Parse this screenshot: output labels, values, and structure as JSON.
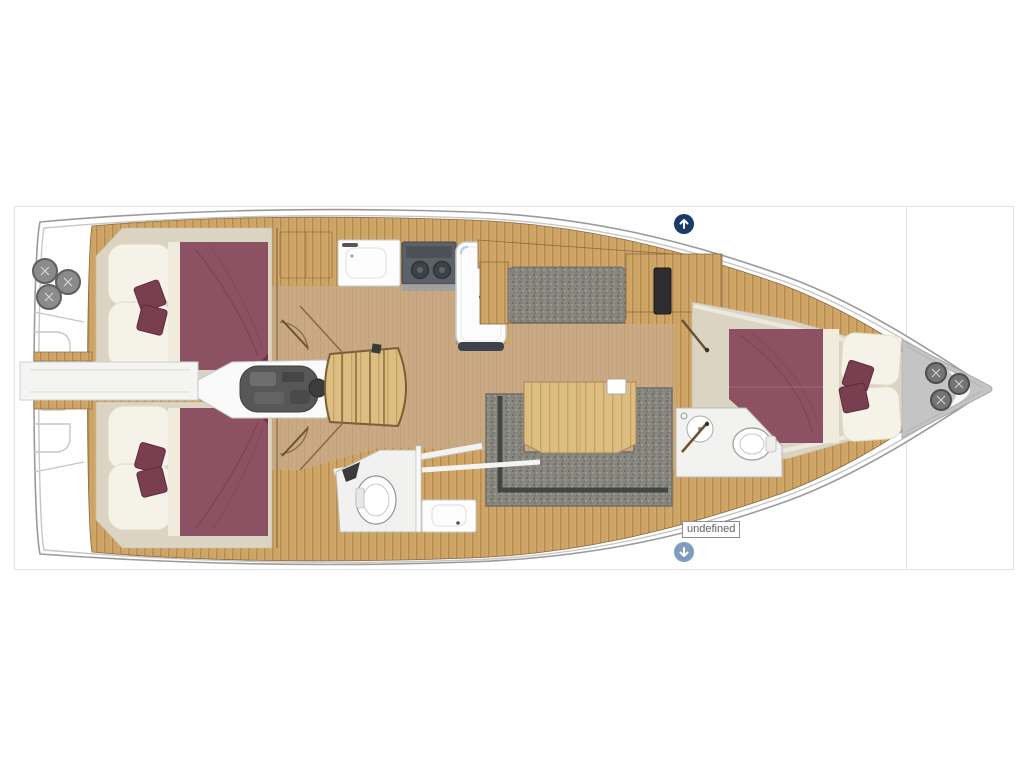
{
  "page": {
    "background": "#ffffff"
  },
  "panel": {
    "border_color": "#e2e2e2"
  },
  "controls": {
    "up_button": {
      "icon": "arrow-up-icon",
      "color": "#1b3a68"
    },
    "down_button": {
      "icon": "arrow-down-icon",
      "color": "#7e9dbe"
    },
    "tooltip": {
      "text": "undefined"
    }
  },
  "floorplan": {
    "subject": "sailboat-interior-floorplan",
    "colors": {
      "border": "#e2e2e2",
      "btn-up": "#1b3a68",
      "btn-down": "#7e9dbe",
      "tooltip-border": "#8f8f8f",
      "tooltip-text": "#5f5f5f",
      "hull-stroke": "#9a9a9a",
      "hull-fill": "#ffffff",
      "wood": "#d0a768",
      "wood-stripe": "#b68d52",
      "wood-edge": "#8a6a3f",
      "floor": "#c8a983",
      "beige": "#dbd4c3",
      "cream": "#f5f2e7",
      "maroon": "#8c5162",
      "maroon-dark": "#7a3e51",
      "sofa-gray": "#86867e",
      "trim-dark": "#3d3d3b",
      "engine": "#575757",
      "stove": "#5c6067",
      "white-fixture": "#fbfbfb",
      "bow-gray": "#c4c4c4",
      "winch": "#747474"
    }
  }
}
